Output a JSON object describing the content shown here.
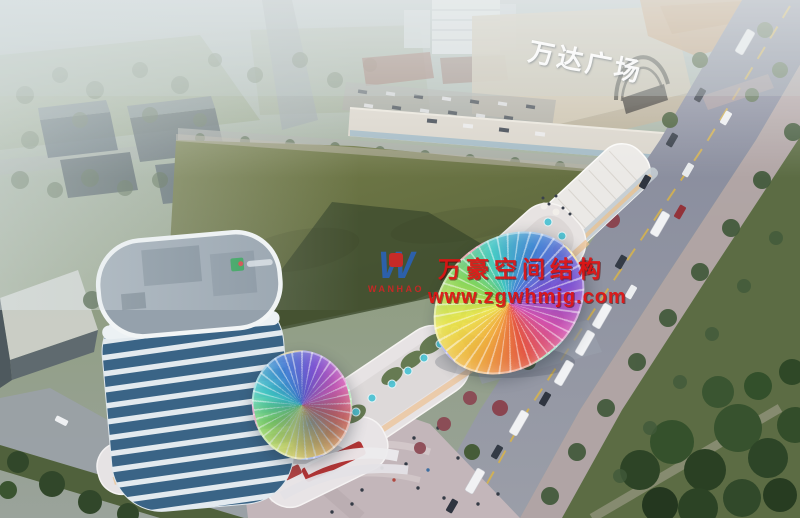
{
  "signs": {
    "mall_roof_sign": "万达广场"
  },
  "watermark": {
    "logo_glyph": "W",
    "logo_text": "WANHAO",
    "company": "万豪空间结构",
    "website": "www.zgwhmjg.com",
    "text_color": "#e01212",
    "logo_blue": "#2b62b4",
    "logo_red": "#d02828"
  },
  "palette": {
    "haze": "#ccd6d8",
    "field_green": "#667243",
    "field_shadow": "#3e4c2e",
    "road_gray": "#8b8f9e",
    "sidewalk_pink": "#b3a4a6",
    "lawn_green": "#5c6c44",
    "tree_dark_green": "#2d4426",
    "tower_glass_blue": "#3a6486",
    "tower_band_white": "#e3eaef",
    "retail_white": "#e7e3e2",
    "umbrella_teal": "#4fc3d4",
    "storefront_red": "#b23434",
    "canopy_rainbow": [
      "#e8533f",
      "#f2a93b",
      "#ece84f",
      "#7fd457",
      "#3fc9c4",
      "#3f7fd4",
      "#7a4fd4",
      "#d44fb0"
    ]
  }
}
